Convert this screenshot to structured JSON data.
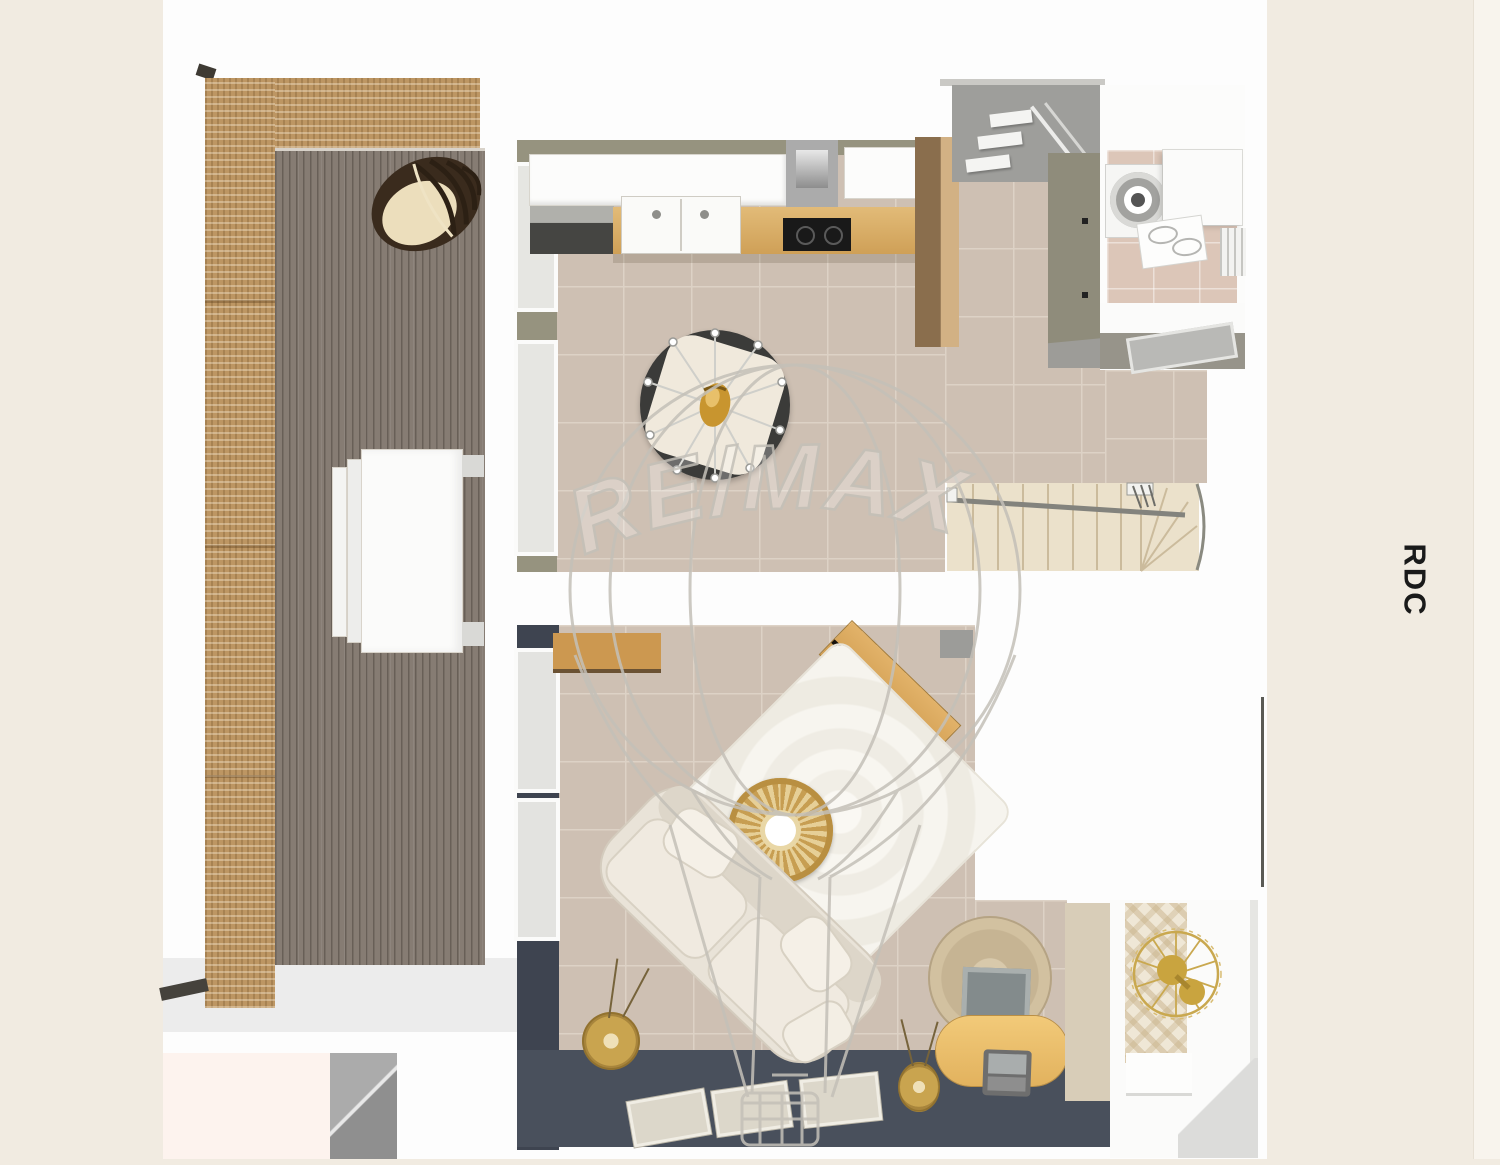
{
  "floor_label": "RDC",
  "watermark_text": "RE/MAX",
  "palette": {
    "cream": "#f1ebe1",
    "plan_white": "#fdfdfd",
    "right_strip": "#f8f4ed",
    "ink": "#1a1a1a",
    "wicker": "#bd9663",
    "deck": "#867c73",
    "tile": "#cec0b3",
    "grout": "#ddd2c6",
    "taupe_wall": "#96937f",
    "navy": "#3e4450",
    "navy_band": "#49505c",
    "wood": "#d8ab63",
    "wood_light": "#d2b184",
    "wood_dark": "#8a6e4d",
    "stair": "#ebe1cb",
    "hall_gray": "#9e9e9b",
    "bath_floor": "#dcc6b8",
    "gold": "#c9a44f",
    "watermark": "#c4c0b8",
    "pink": "#fdf3ee",
    "sofa": "#e9e3d8",
    "rug": "#f7f5ef"
  }
}
